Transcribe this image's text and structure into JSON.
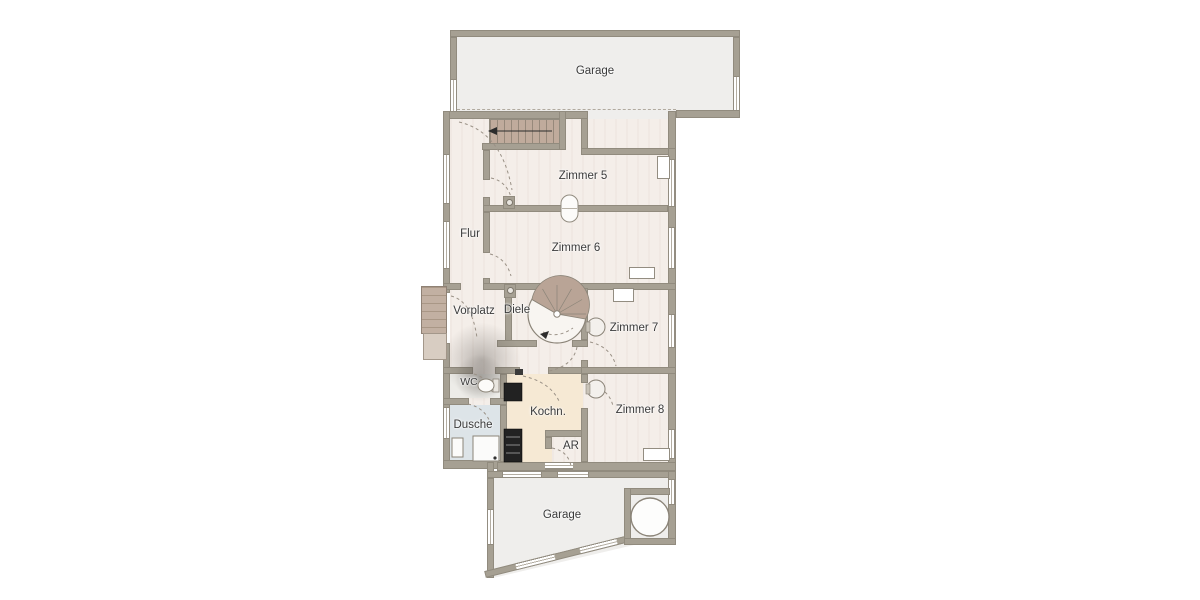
{
  "plan": {
    "title": "floor-plan",
    "rooms": {
      "garage_top": {
        "label": "Garage"
      },
      "zimmer5": {
        "label": "Zimmer 5"
      },
      "flur": {
        "label": "Flur"
      },
      "zimmer6": {
        "label": "Zimmer 6"
      },
      "vorplatz": {
        "label": "Vorplatz"
      },
      "diele": {
        "label": "Diele"
      },
      "zimmer7": {
        "label": "Zimmer 7"
      },
      "wc": {
        "label": "WC"
      },
      "kochn": {
        "label": "Kochn."
      },
      "zimmer8": {
        "label": "Zimmer 8"
      },
      "dusche": {
        "label": "Dusche"
      },
      "ar": {
        "label": "AR"
      },
      "garage_bottom": {
        "label": "Garage"
      }
    },
    "colors": {
      "wall": "#a6a093",
      "room_floor": "#f4eee9",
      "garage_floor": "#efeeec",
      "kitchen_floor": "#f6e9d4",
      "shower_floor": "#dde4e8",
      "wc_floor": "#edece8",
      "stair_tread": "#c0ab9c",
      "steps": "#c2b0a2",
      "outline": "#938d81",
      "text": "#3a3a3a"
    }
  }
}
